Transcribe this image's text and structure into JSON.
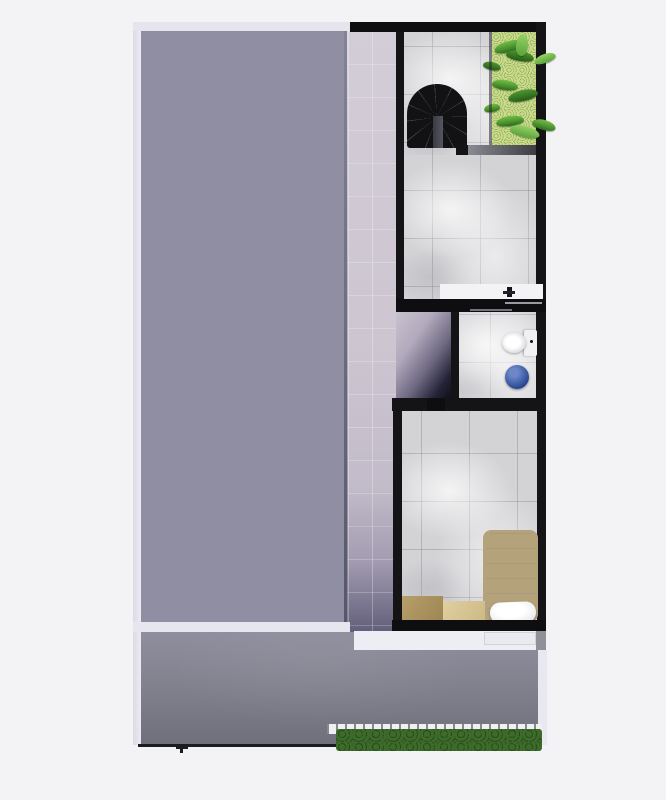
{
  "scene": {
    "title": "Top-down 3D render of a narrow house floor plan",
    "background_color": "#f3f3f6",
    "no_visible_text": true
  },
  "regions": {
    "roof_terrace": {
      "label": "Large roof terrace slab (left)",
      "color_top": "#9d9caf",
      "color_bottom": "#686983"
    },
    "corridor": {
      "label": "Side corridor with light mauve tiles",
      "color_top": "#d3cdd7",
      "color_shadow": "#625f7b"
    },
    "stair_room": {
      "label": "Stair landing room (top right)",
      "floor": "marble tile",
      "tile_color": "#d3d3d6"
    },
    "bathroom": {
      "label": "Bathroom with vanity counter",
      "floor": "marble tile"
    },
    "toilet_room": {
      "label": "Toilet room (middle right)",
      "floor": "marble tile"
    },
    "bedroom": {
      "label": "Bedroom (bottom right)",
      "floor": "marble tile"
    },
    "doorway_passage": {
      "label": "Open passage with shadow gradient",
      "colors": [
        "#c8c1cd",
        "#101018"
      ]
    },
    "patio": {
      "label": "Lower patio deck",
      "color_top": "#8e8e9e",
      "color_bottom": "#6f6f7b"
    },
    "balconies": {
      "label": "White edge strips / balcony ledges",
      "color": "#edeef3"
    }
  },
  "objects": {
    "spiral_staircase": {
      "label": "Black spiral staircase",
      "color": "#121214",
      "slot_color": "#50505a"
    },
    "planter_top": {
      "label": "Green planter bed with plants (top right)",
      "grass_color": "#a3bf5c",
      "leaf_colors": [
        "#78bd48",
        "#4d9630",
        "#2e6b1d"
      ]
    },
    "planter_curb": {
      "label": "Planter curb",
      "color_gradient": [
        "#8a8a92",
        "#3c3c42"
      ]
    },
    "vanity_counter": {
      "label": "White vanity counter with faucet",
      "counter_color": "#f3f3f5",
      "faucet_color": "#15151c"
    },
    "toilet": {
      "label": "Toilet with tank",
      "color": "#f4f4f6"
    },
    "bucket": {
      "label": "Blue round bucket",
      "color": "#3b5ca6"
    },
    "bed": {
      "label": "Single bed with pillow",
      "frame_color": "#b3a27a",
      "mattress_color": "#e6e6ea",
      "pillow_color": "#f2f2f5"
    },
    "box_dark": {
      "label": "Tan box / cabinet",
      "color": "#ad9563"
    },
    "box_light": {
      "label": "Light tan box / cabinet",
      "color": "#d9c89c"
    },
    "hedge": {
      "label": "Dark green hedge row (bottom)",
      "colors": [
        "#0c140a",
        "#3d6b2a",
        "#47772f"
      ]
    },
    "fence_rail": {
      "label": "White fence rail with posts",
      "color": "#eff0f3"
    },
    "fence_line": {
      "label": "Thin black fence line (bottom left)",
      "color": "#1c1c1e"
    }
  },
  "palette": {
    "background": "#f3f3f6",
    "wall_black": "#141417",
    "wall_white": "#e6e5ee",
    "tile_base": "#d3d3d6",
    "tile_joint": "#7d7d87",
    "accent_green": "#4d9630",
    "accent_blue": "#3b5ca6"
  }
}
